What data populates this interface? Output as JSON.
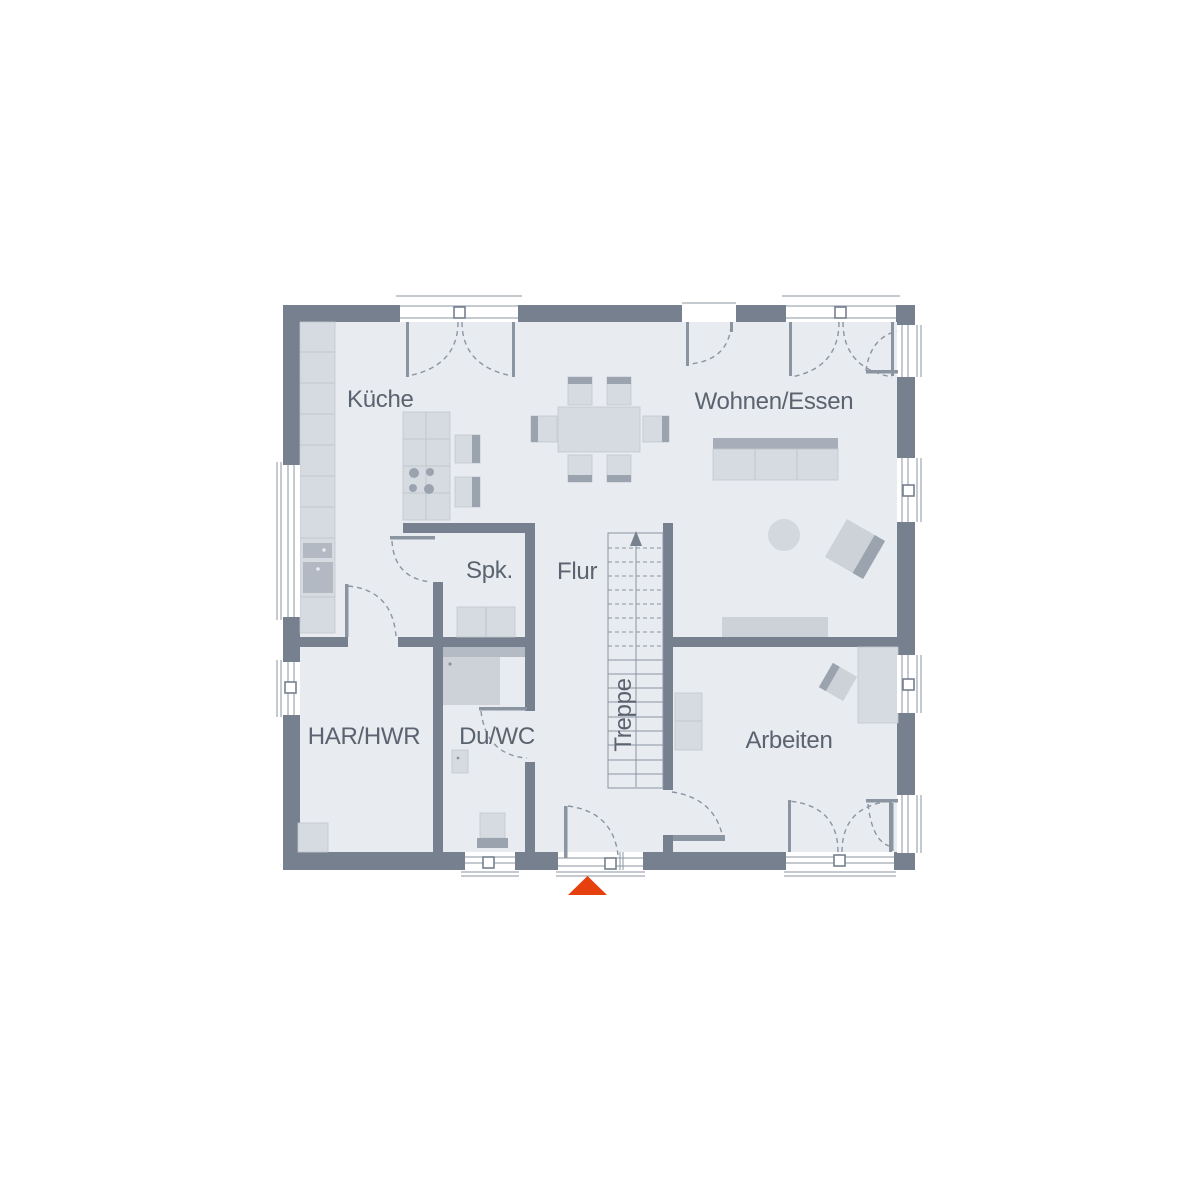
{
  "plan": {
    "title_hint": "floor-plan",
    "rooms": [
      {
        "id": "kueche",
        "label": "Küche"
      },
      {
        "id": "wohnen-essen",
        "label": "Wohnen/Essen"
      },
      {
        "id": "spk",
        "label": "Spk."
      },
      {
        "id": "flur",
        "label": "Flur"
      },
      {
        "id": "treppe",
        "label": "Treppe"
      },
      {
        "id": "har-hwr",
        "label": "HAR/HWR"
      },
      {
        "id": "du-wc",
        "label": "Du/WC"
      },
      {
        "id": "arbeiten",
        "label": "Arbeiten"
      }
    ],
    "stairs": {
      "direction": "up",
      "steps_dashed": 8,
      "steps_solid": 9
    },
    "entrance_marker": {
      "shape": "triangle",
      "color": "#e7400f"
    },
    "colors": {
      "wall": "#76808e",
      "floor": "#e8ebf0",
      "line": "#8b95a2",
      "furn": "#d6dae1",
      "furn_mid": "#cdd2d9",
      "furn_dark": "#9ba3af",
      "furn_edge": "#c2c8d0",
      "appliance": "#b2b9c3",
      "sofa_back": "#a7aeb9",
      "text": "#5a636f",
      "accent": "#e7400f",
      "white": "#ffffff"
    }
  }
}
